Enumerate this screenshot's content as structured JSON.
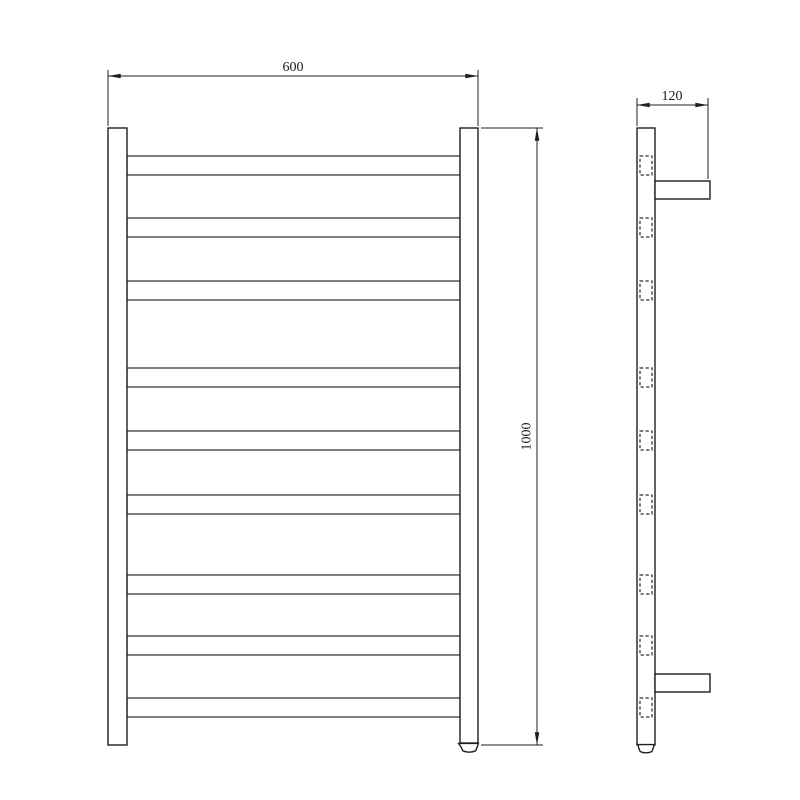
{
  "colors": {
    "background": "#ffffff",
    "line": "#1f1f1f",
    "text": "#1a1a1a"
  },
  "dimensions": {
    "width_label": "600",
    "height_label": "1000",
    "depth_label": "120"
  },
  "front_view": {
    "rung_tops": [
      156,
      218,
      281,
      368,
      431,
      495,
      575,
      636,
      698
    ],
    "rung_height": 19,
    "rung_left": 127,
    "rung_right": 460
  },
  "side_view": {
    "section_tops": [
      156,
      218,
      281,
      368,
      431,
      495,
      575,
      636,
      698
    ],
    "section_x": 640,
    "section_width": 12,
    "section_height": 19,
    "bracket_tops": [
      181,
      674
    ],
    "bracket_x": 655,
    "bracket_width": 55,
    "bracket_height": 18
  }
}
